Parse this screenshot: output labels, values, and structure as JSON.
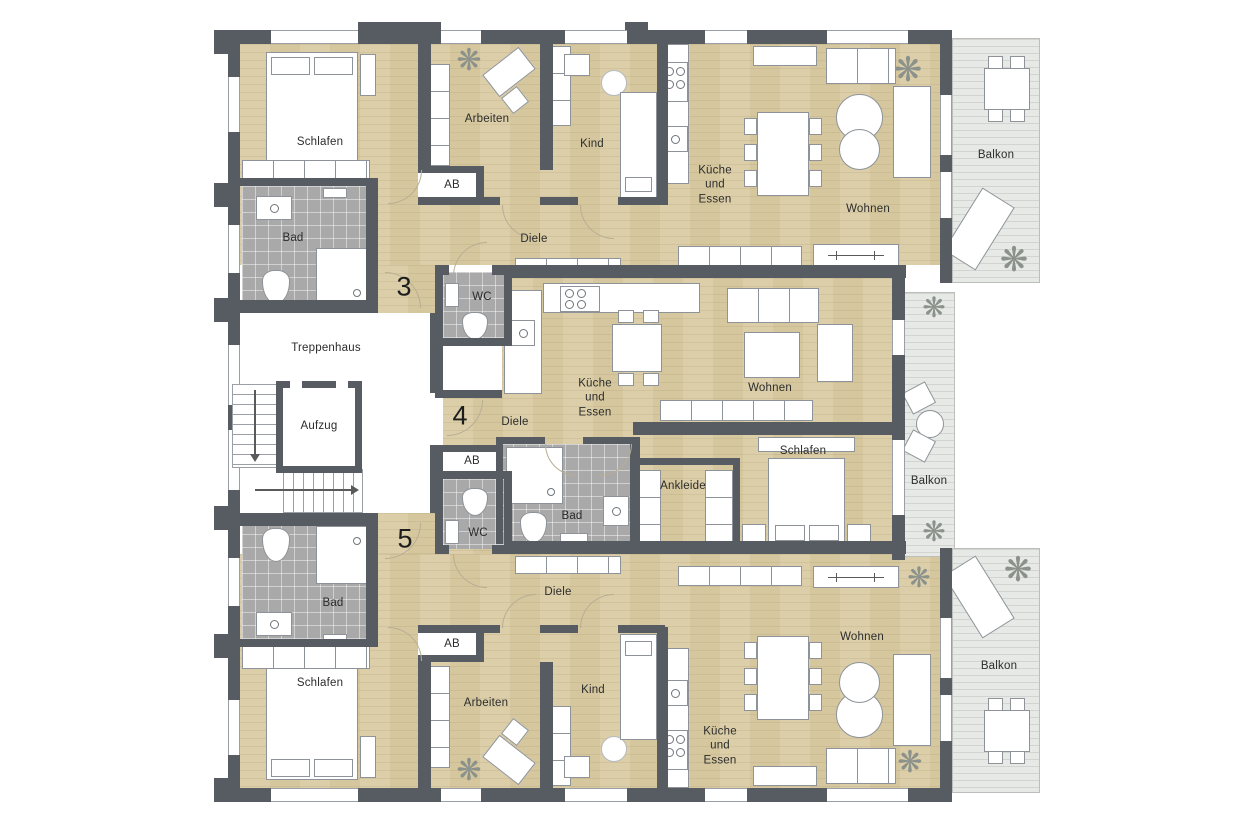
{
  "units": {
    "u3": "3",
    "u4": "4",
    "u5": "5"
  },
  "rooms": {
    "apt3": {
      "schlafen": "Schlafen",
      "bad": "Bad",
      "arbeiten": "Arbeiten",
      "ab": "AB",
      "kind": "Kind",
      "kueche": "Küche und Essen",
      "diele": "Diele",
      "wc": "WC",
      "wohnen": "Wohnen",
      "balkon": "Balkon"
    },
    "apt4": {
      "diele": "Diele",
      "ab": "AB",
      "kueche": "Küche und Essen",
      "wohnen": "Wohnen",
      "schlafen": "Schlafen",
      "ankleide": "Ankleide",
      "bad": "Bad",
      "balkon": "Balkon"
    },
    "apt5": {
      "wc": "WC",
      "bad": "Bad",
      "diele": "Diele",
      "ab": "AB",
      "schlafen": "Schlafen",
      "arbeiten": "Arbeiten",
      "kind": "Kind",
      "kueche": "Küche und Essen",
      "wohnen": "Wohnen",
      "balkon": "Balkon"
    },
    "core": {
      "treppenhaus": "Treppenhaus",
      "aufzug": "Aufzug"
    }
  },
  "icons": {
    "plant": "❋"
  }
}
